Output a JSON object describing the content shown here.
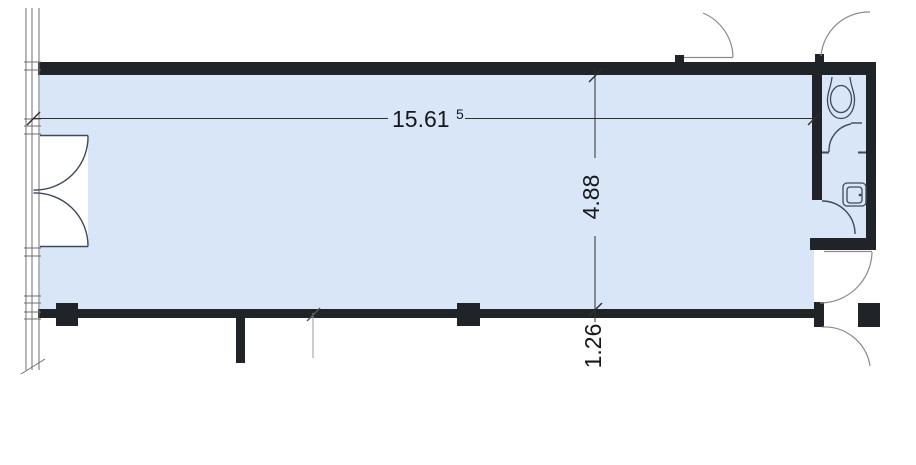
{
  "drawing": {
    "type": "architectural-floor-plan",
    "room_fill_color": "#d9e6f8",
    "wall_color": "#202327",
    "line_color": "#3e4a59",
    "window_line_color": "#6f6f6f",
    "door_arc_color": "#8a8a8a",
    "dimension_color": "#2f2f2f",
    "dimension_text_color": "#15181c"
  },
  "dimensions": {
    "width": {
      "value": "15.61",
      "superscript": "5"
    },
    "depth": {
      "value": "4.88"
    },
    "offset": {
      "value": "1.26"
    }
  },
  "fixtures": [
    {
      "name": "toilet"
    },
    {
      "name": "washbasin"
    }
  ]
}
